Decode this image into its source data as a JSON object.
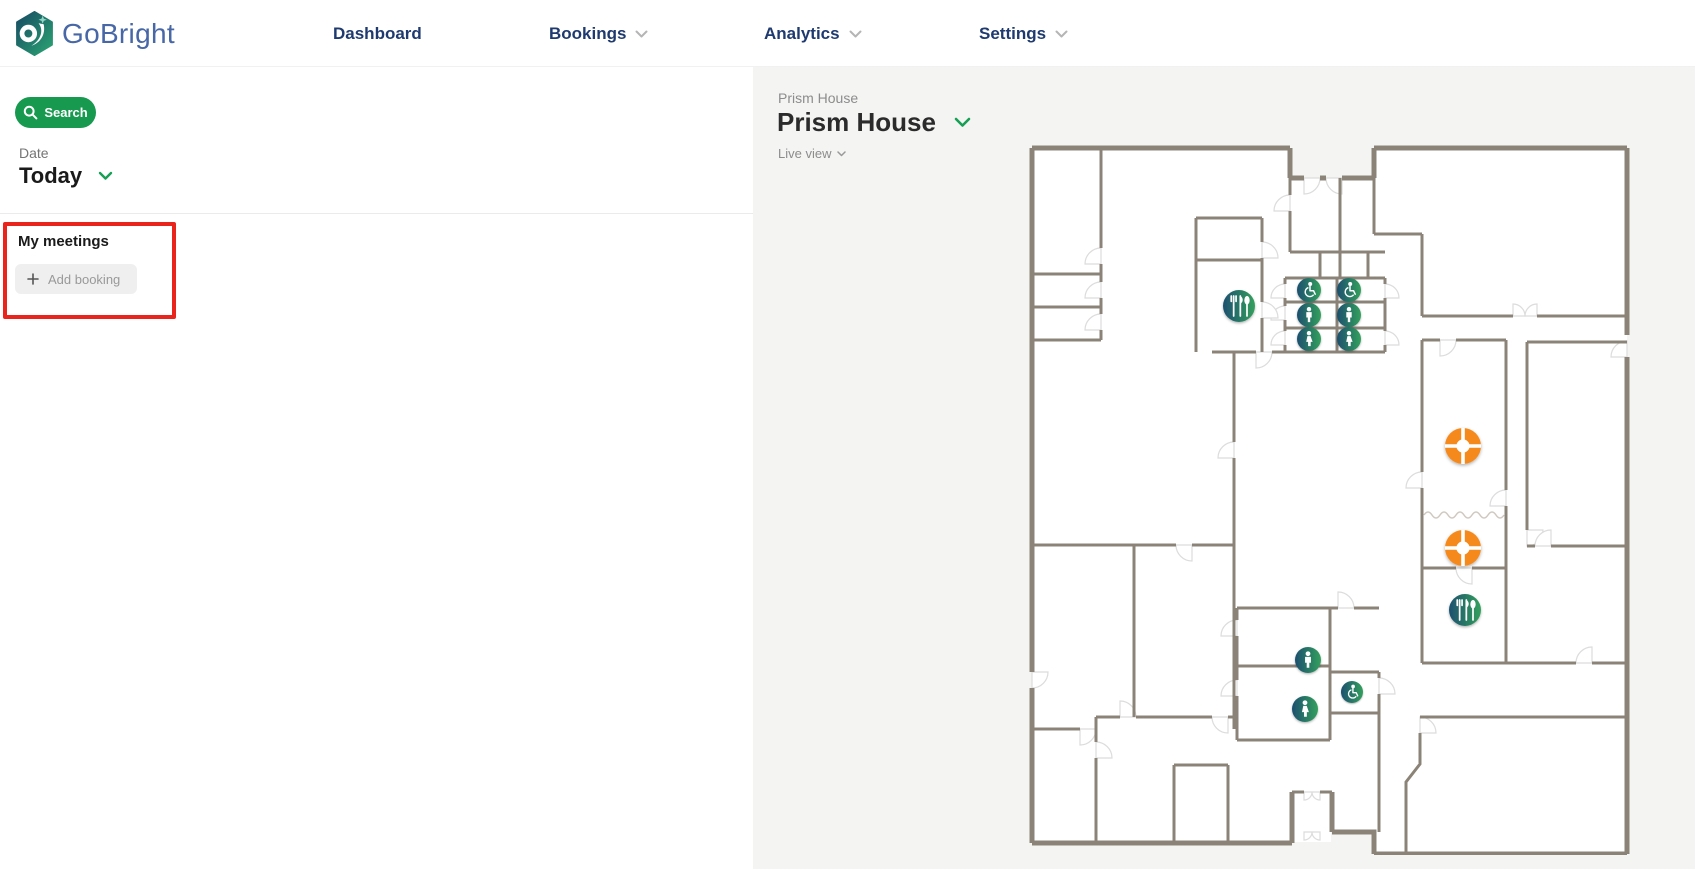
{
  "brand": {
    "name": "GoBright"
  },
  "nav": {
    "items": [
      {
        "label": "Dashboard",
        "has_dropdown": false
      },
      {
        "label": "Bookings",
        "has_dropdown": true
      },
      {
        "label": "Analytics",
        "has_dropdown": true
      },
      {
        "label": "Settings",
        "has_dropdown": true
      }
    ]
  },
  "sidebar": {
    "search_button_label": "Search",
    "date_label": "Date",
    "date_value": "Today",
    "my_meetings_title": "My meetings",
    "add_booking_label": "Add booking"
  },
  "map_panel": {
    "breadcrumb": "Prism House",
    "title": "Prism House",
    "view_mode_label": "Live view",
    "icons": [
      {
        "type": "accessible-toilet",
        "x": 293,
        "y": 148,
        "r": 12
      },
      {
        "type": "accessible-toilet",
        "x": 333,
        "y": 148,
        "r": 12
      },
      {
        "type": "mens-toilet",
        "x": 293,
        "y": 173,
        "r": 12
      },
      {
        "type": "mens-toilet",
        "x": 333,
        "y": 173,
        "r": 12
      },
      {
        "type": "womens-toilet",
        "x": 293,
        "y": 197,
        "r": 12
      },
      {
        "type": "womens-toilet",
        "x": 333,
        "y": 197,
        "r": 12
      },
      {
        "type": "restaurant",
        "x": 223,
        "y": 164,
        "r": 16
      },
      {
        "type": "coffee-point",
        "x": 447,
        "y": 304,
        "r": 18
      },
      {
        "type": "coffee-point",
        "x": 447,
        "y": 406,
        "r": 18
      },
      {
        "type": "restaurant",
        "x": 449,
        "y": 468,
        "r": 16
      },
      {
        "type": "mens-toilet",
        "x": 292,
        "y": 518,
        "r": 13
      },
      {
        "type": "womens-toilet",
        "x": 289,
        "y": 567,
        "r": 13
      },
      {
        "type": "accessible-toilet",
        "x": 336,
        "y": 550,
        "r": 11
      }
    ]
  },
  "annotation": {
    "shape": "rectangle",
    "color": "#e8241d",
    "purpose": "highlight-my-meetings-section"
  },
  "colors": {
    "accent_green": "#17994f",
    "nav_blue": "#1e3a6e",
    "wall": "#8b8378",
    "panel_bg": "#f4f4f3",
    "icon_gradient_start": "#1d4f70",
    "icon_gradient_end": "#33a05c",
    "coffee_orange": "#f6891f",
    "annotation_red": "#e8241d"
  }
}
